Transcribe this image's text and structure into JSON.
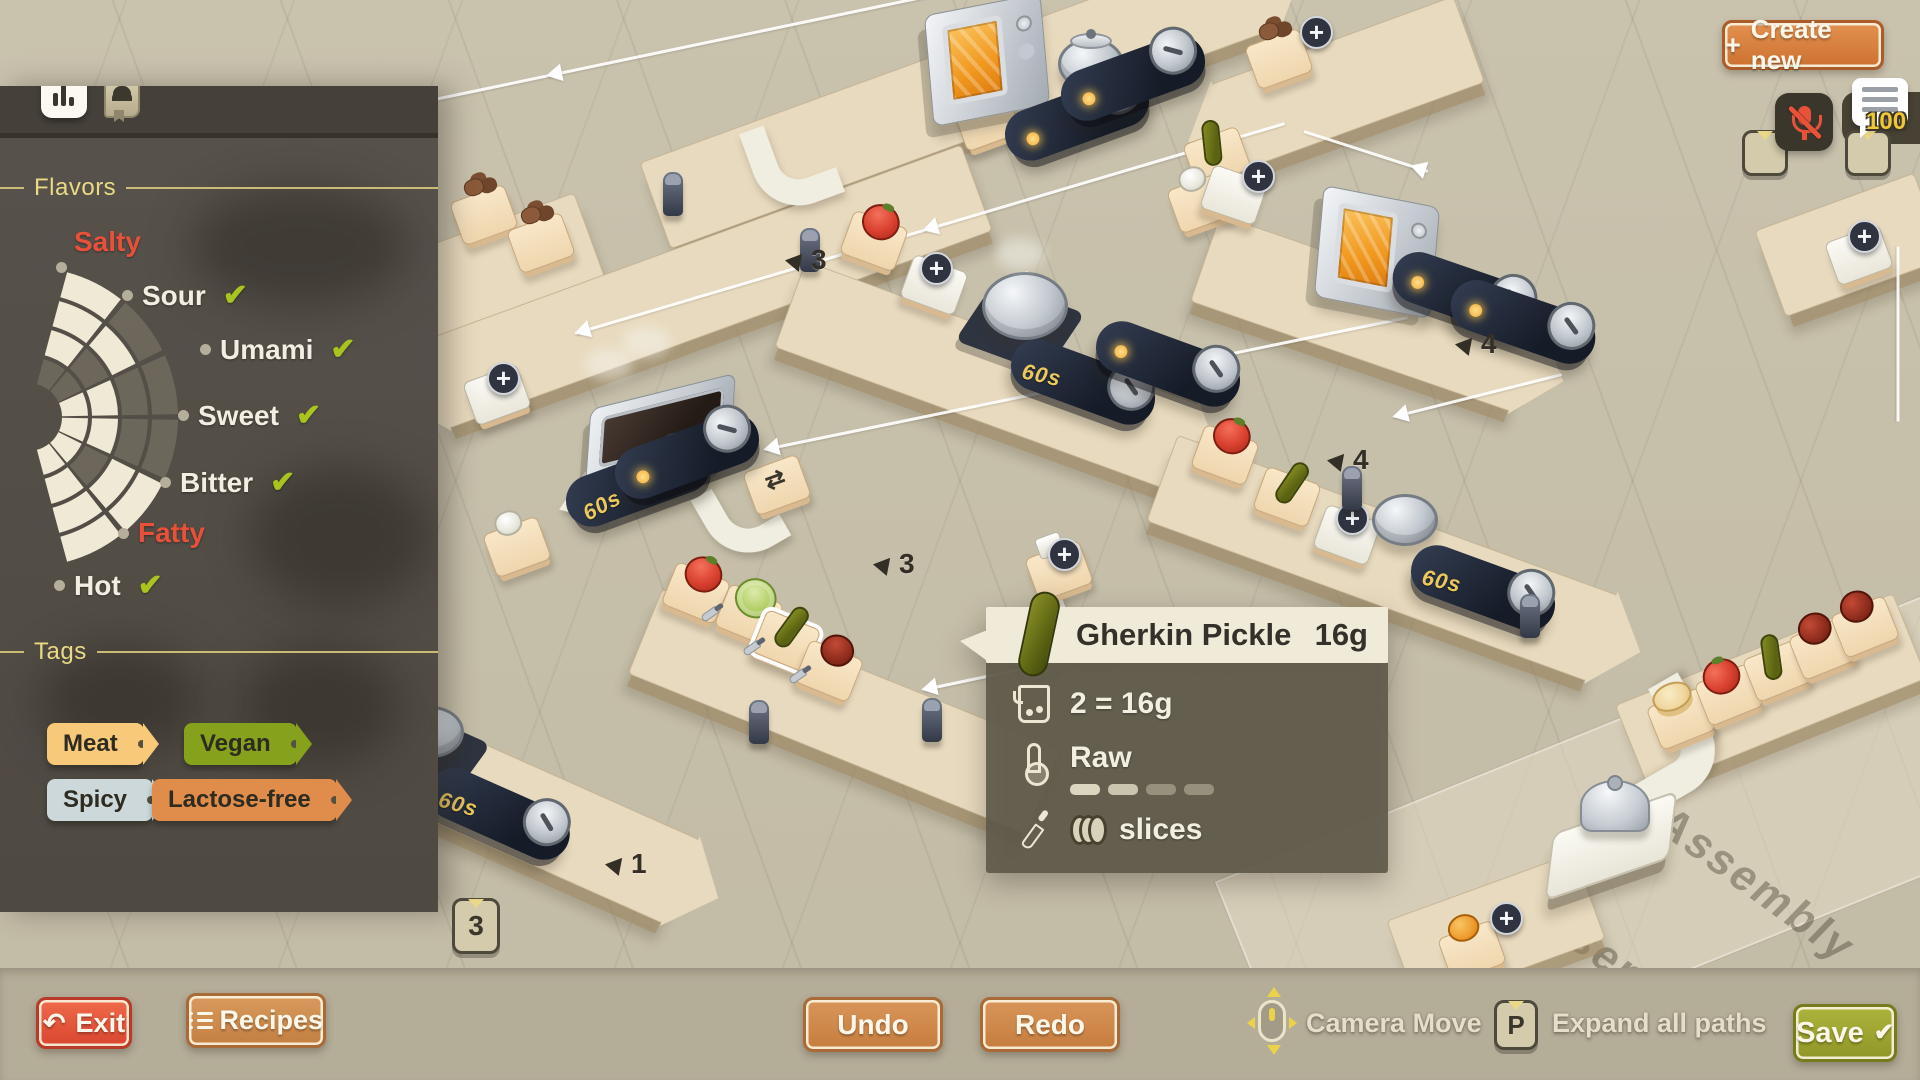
{
  "panel": {
    "flavors_title": "Flavors",
    "flavors": [
      {
        "label": "Salty",
        "checked": false,
        "highlight": true
      },
      {
        "label": "Sour",
        "checked": true,
        "highlight": false
      },
      {
        "label": "Umami",
        "checked": true,
        "highlight": false
      },
      {
        "label": "Sweet",
        "checked": true,
        "highlight": false
      },
      {
        "label": "Bitter",
        "checked": true,
        "highlight": false
      },
      {
        "label": "Fatty",
        "checked": false,
        "highlight": true
      },
      {
        "label": "Hot",
        "checked": true,
        "highlight": false
      }
    ],
    "wheel": {
      "type": "radial-gauge",
      "sectors": 6,
      "rings": 4,
      "filled": [
        [
          0,
          1,
          1,
          1
        ],
        [
          0,
          0,
          1,
          0
        ],
        [
          1,
          1,
          0,
          0
        ],
        [
          1,
          1,
          0,
          0
        ],
        [
          1,
          0,
          1,
          1
        ],
        [
          1,
          1,
          1,
          1
        ]
      ],
      "filled_color": "#f0e9d5",
      "empty_color": "rgba(130,123,108,0.55)"
    },
    "tags_title": "Tags",
    "tags": [
      {
        "label": "Meat",
        "color": "#f8c979"
      },
      {
        "label": "Vegan",
        "color": "#86a21d"
      },
      {
        "label": "Spicy",
        "color": "#cdd8da"
      },
      {
        "label": "Lactose-free",
        "color": "#e08d4b"
      }
    ],
    "hotkey_badge": "3"
  },
  "tooltip": {
    "title": "Gherkin Pickle",
    "weight": "16g",
    "quantity": "2 = 16g",
    "state": "Raw",
    "state_meter": {
      "filled": 2,
      "total": 4
    },
    "prep": "slices"
  },
  "top_right": {
    "create_new_label": "Create new",
    "plus_icon": "+",
    "counter_badge": "100"
  },
  "bottom_bar": {
    "exit": "Exit",
    "recipes": "Recipes",
    "undo": "Undo",
    "redo": "Redo",
    "camera_move": "Camera Move",
    "expand_all_paths": "Expand all paths",
    "expand_key": "P",
    "save": "Save"
  },
  "scene": {
    "timer_label": "60s",
    "floor_label": "Assembly",
    "badges": [
      "3",
      "4",
      "4",
      "1",
      "3"
    ]
  },
  "colors": {
    "accent_orange": "#cc7131",
    "danger_red": "#d94630",
    "save_olive": "#8f9626",
    "check_green": "#a9c41e",
    "flavor_red": "#e8503a",
    "header_yellow": "#ead985"
  }
}
